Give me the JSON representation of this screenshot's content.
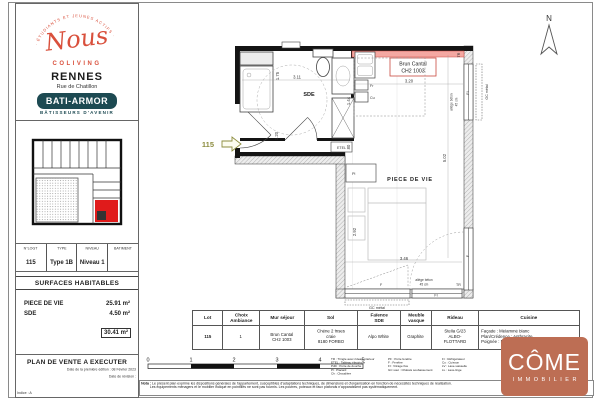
{
  "sidebar": {
    "brand": {
      "arc_text": "· ÉTUDIANTS ET JEUNES ACTIFS ·",
      "logo_text": "Nous",
      "logo_sub": "COLIVING",
      "city": "RENNES",
      "street": "Rue de Chatillon",
      "builder": "BATI-ARMOR",
      "builder_tagline": "BÂTISSEURS D'AVENIR"
    },
    "lot_table": {
      "headers": [
        "N°LOGT",
        "TYPE",
        "NIVEAU",
        "BATIMENT"
      ],
      "values": [
        "115",
        "Type 1B",
        "Niveau 1",
        ""
      ]
    },
    "surfaces": {
      "title": "SURFACES HABITABLES",
      "rows": [
        {
          "label": "PIECE DE VIE",
          "value": "25.91 m²"
        },
        {
          "label": "SDE",
          "value": "4.50 m²"
        }
      ],
      "total": "30.41 m²"
    },
    "footer": {
      "title": "PLAN DE VENTE A EXECUTER",
      "edition": "Date de la première édition : 08 Février 2023",
      "revision": "Date de révision :",
      "indice": "Indice : A"
    }
  },
  "plan": {
    "north_label": "N",
    "unit": "115",
    "sde": "SDE",
    "pdv": "PIECE DE VIE",
    "accent1": "Brun Cantal",
    "accent2": "CH2 1003",
    "d_311": "3.11",
    "d_175": "1.75",
    "d_120": "1.20",
    "d_320": "3.20",
    "d_144": "1.44",
    "d_080": "80",
    "d_502": "5.02",
    "d_292": "2.92",
    "d_346": "3.46",
    "etel": "ETEL",
    "fr": "Fr",
    "cu": "Cu",
    "pl": "Pl",
    "tr_top": "TR",
    "tr_bottom": "TR",
    "fi_right": "FI",
    "f_right": "F",
    "f_bottom": "F",
    "fi_bottom": "FI",
    "gc_right": "GC métal",
    "gc_bottom": "GC métal",
    "allege_r1": "allège béton",
    "allege_r2": "45 cm",
    "allege_b1": "allège béton",
    "allege_b2": "45 cm"
  },
  "finishes": {
    "headers": [
      "Lot",
      "Choix\nAmbiance",
      "Mur séjour",
      "Sol",
      "Faïence\nSDE",
      "Meuble\nvasque",
      "Rideau",
      "Cuisine"
    ],
    "values": [
      "115",
      "1",
      "Brun Cantal\nCH2 1003",
      "Chêne 2 frises craie\n8180 FORBO",
      "Alpo White",
      "Graphite",
      "Stella G/23\nALBO-FLOTTARD",
      "Façade : Mélaminé blanc\nPlan/Crédence : Anthracite\nPoignée : Noire"
    ]
  },
  "scalebar": {
    "ticks": [
      "0",
      "1",
      "2",
      "3",
      "4",
      "5"
    ]
  },
  "legend": {
    "col1": [
      "TR : Tringle avec rideau intérieur",
      "ETEL : Tableau électrique",
      "PdD : Porte de douche",
      "Pl : Placard",
      "Ch : Chaudière"
    ],
    "col2": [
      "PF : Porte fenêtre",
      "F : Fenêtre",
      "FI : Vitrage fixe",
      "GC sout : Châssis soubassement"
    ],
    "col3": [
      "Fr : Réfrigérateur",
      "Cu : Cuisson",
      "LV : Lave-vaisselle",
      "LL : Lave-linge"
    ]
  },
  "nota": {
    "label": "Nota :",
    "line1": "Le présent plan exprime les dispositions générales de l'appartement, susceptibles d'adaptations techniques, de dimensions et d'organisation en fonction de nécessités techniques de réalisation.",
    "line2": "Les équipements ménagers et le mobilier indiqué en pointillés ne sont pas fournis. Les poutres, poteaux et faux plafonds n'apparaissent pas systématiquement."
  },
  "come": {
    "title": "CÔME",
    "subtitle": "IMMOBILIER"
  },
  "colors": {
    "brand_red": "#d9503c",
    "builder_teal": "#1d4a52",
    "accent_wall": "#f4a8a2",
    "accent_border": "#cc4a42",
    "unit_red": "#e01b1b",
    "unit_label_olive": "#8d8d3f",
    "come_terracotta": "#bd6e54"
  }
}
